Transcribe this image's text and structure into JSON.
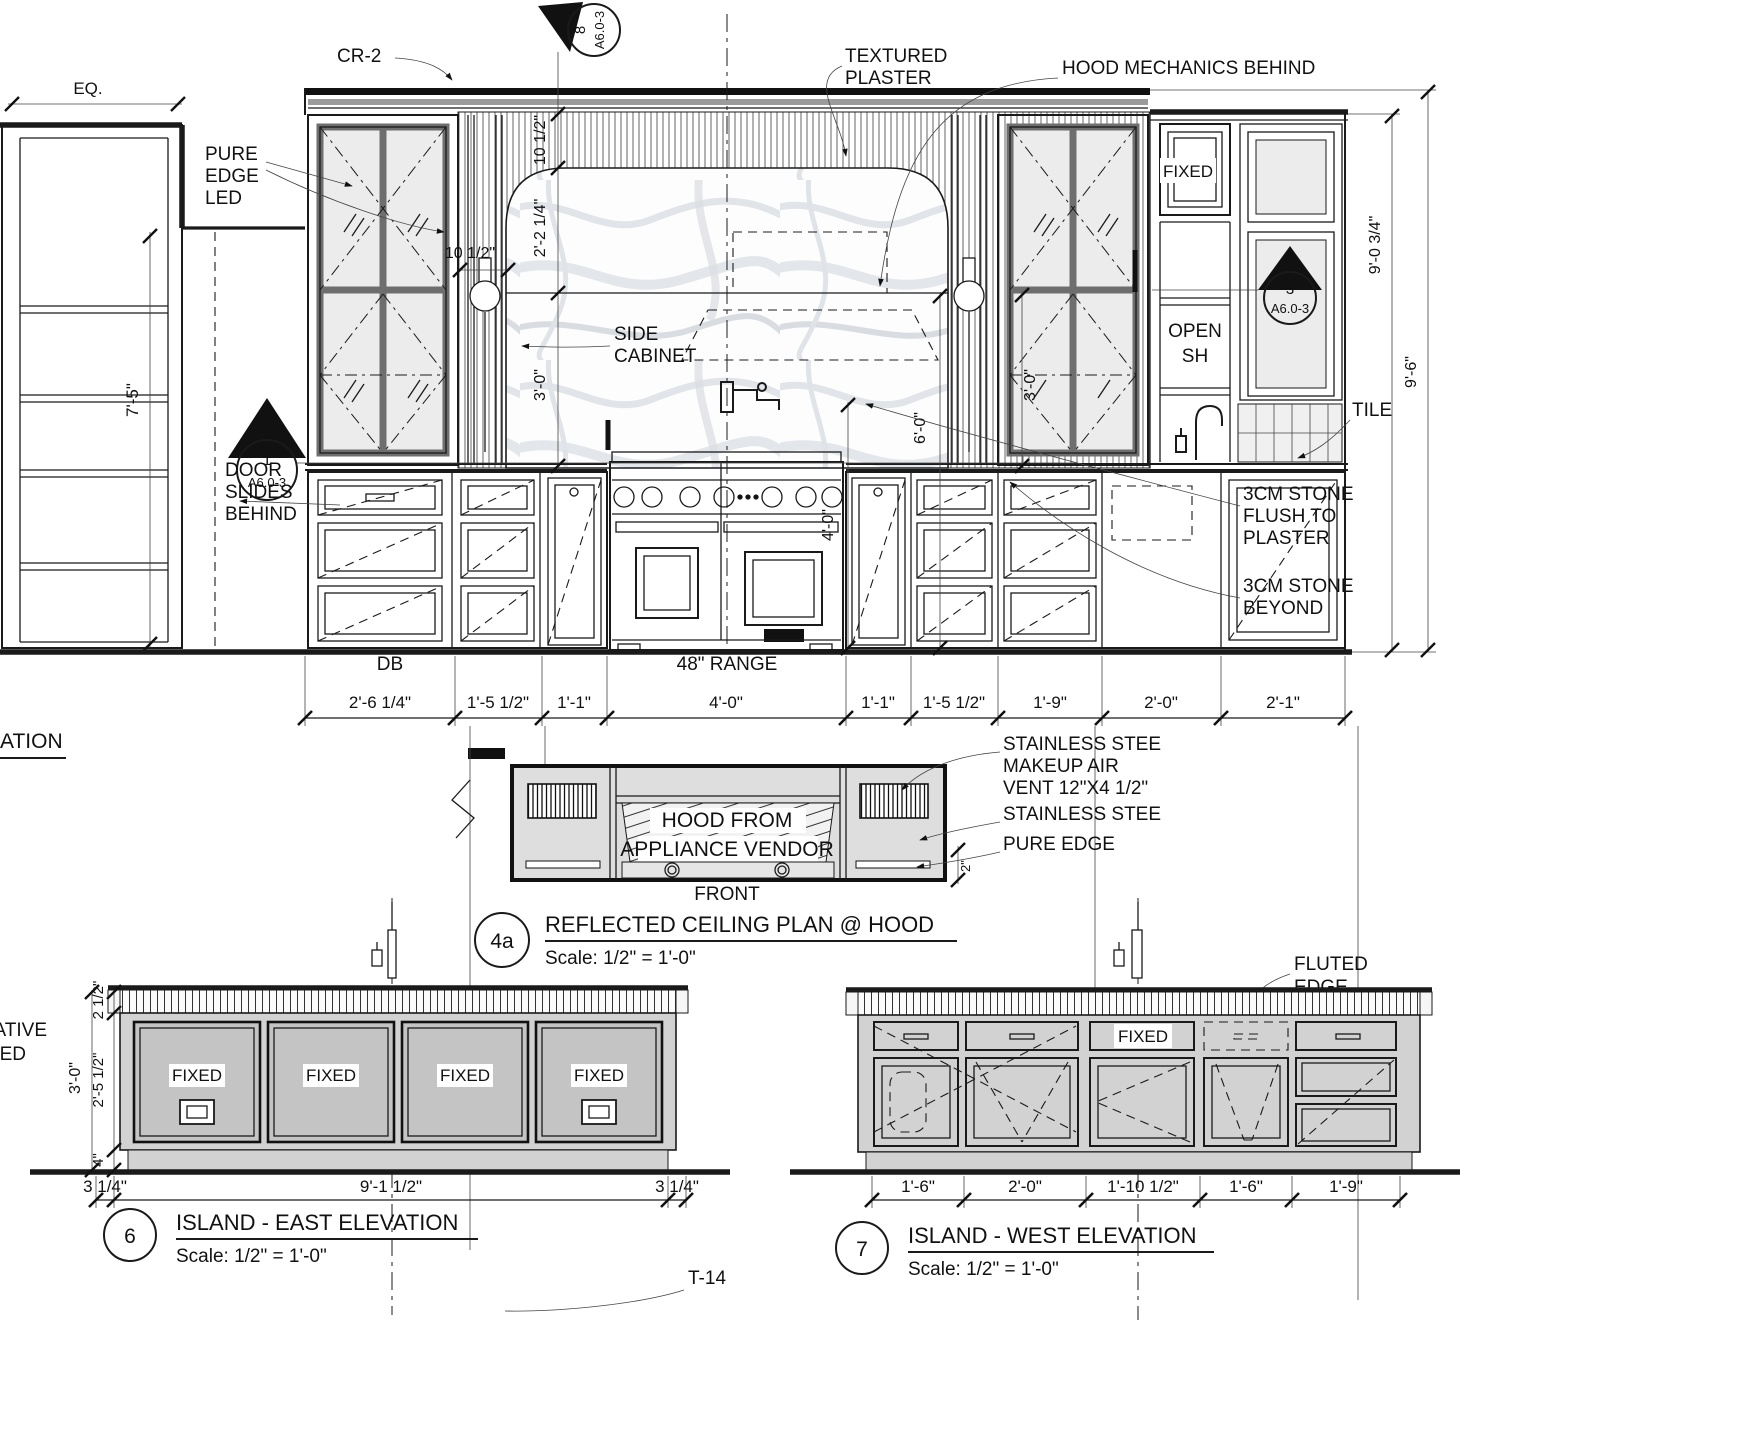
{
  "colors": {
    "ink": "#1a1a1a",
    "panel_gray": "#c6c6c6",
    "body_gray": "#d2d2d2",
    "rcp_gray": "#dedede",
    "glass": "#ececec"
  },
  "main": {
    "eq": "EQ.",
    "cr2": "CR-2",
    "pure_edge_led": [
      "PURE",
      "EDGE",
      "LED"
    ],
    "textured_plaster": [
      "TEXTURED",
      "PLASTER"
    ],
    "hood_mechanics": "HOOD MECHANICS BEHIND",
    "side_cabinet": [
      "SIDE",
      "CABINET"
    ],
    "door_slides": [
      "DOOR",
      "SLIDES",
      "BEHIND"
    ],
    "fixed": "FIXED",
    "open_shelf": [
      "OPEN",
      "SH"
    ],
    "tile": "TILE",
    "stone_flush": [
      "3CM STONE",
      "FLUSH TO",
      "PLASTER"
    ],
    "stone_beyond": [
      "3CM STONE",
      "BEYOND"
    ],
    "db": "DB",
    "range_label": "48\" RANGE",
    "partial_title": "ATION",
    "markers": {
      "top": {
        "num": "8",
        "sheet": "A6.0-3"
      },
      "left": {
        "num": "1",
        "sheet": "A6.0-3"
      },
      "right": {
        "num": "3",
        "sheet": "A6.0-3"
      }
    },
    "dims": {
      "left_height": "7'-5\"",
      "cab_to_arch": "10 1/2\"",
      "crown_to_arch": "10 1/2\"",
      "arch_to_hood": "2'-2 1/4\"",
      "backsplash_left": "3'-0\"",
      "backsplash_right": "3'-0\"",
      "hood_height": "6'-0\"",
      "potfiller_height": "4'-0\"",
      "right_height_1": "9'-0 3/4\"",
      "right_height_2": "9'-6\"",
      "bottom": [
        "2'-6 1/4\"",
        "1'-5 1/2\"",
        "1'-1\"",
        "4'-0\"",
        "1'-1\"",
        "1'-5 1/2\"",
        "1'-9\"",
        "2'-0\"",
        "2'-1\""
      ]
    }
  },
  "rcp": {
    "hood_text": [
      "HOOD FROM",
      "APPLIANCE VENDOR"
    ],
    "front": "FRONT",
    "makeup_air": [
      "STAINLESS STEE",
      "MAKEUP AIR",
      "VENT 12\"X4 1/2\""
    ],
    "stainless": "STAINLESS STEE",
    "pure_edge": "PURE EDGE",
    "edge_dim": "2\"",
    "num": "4a",
    "title": "REFLECTED CEILING PLAN @ HOOD",
    "scale": "Scale: 1/2\" = 1'-0\""
  },
  "island_east": {
    "fixed": [
      "FIXED",
      "FIXED",
      "FIXED",
      "FIXED"
    ],
    "partial": [
      "ATIVE",
      "ED"
    ],
    "dims_left": {
      "overall": "3'-0\"",
      "top": "2 1/2\"",
      "mid": "2'-5 1/2\"",
      "base": "4\""
    },
    "dims_bottom": [
      "3 1/4\"",
      "9'-1 1/2\"",
      "3 1/4\""
    ],
    "num": "6",
    "title": "ISLAND - EAST ELEVATION",
    "scale": "Scale: 1/2\" = 1'-0\"",
    "tag": "T-14"
  },
  "island_west": {
    "fluted_edge": [
      "FLUTED",
      "EDGE"
    ],
    "fixed": "FIXED",
    "dims_bottom": [
      "1'-6\"",
      "2'-0\"",
      "1'-10 1/2\"",
      "1'-6\"",
      "1'-9\""
    ],
    "num": "7",
    "title": "ISLAND - WEST ELEVATION",
    "scale": "Scale: 1/2\" = 1'-0\""
  }
}
